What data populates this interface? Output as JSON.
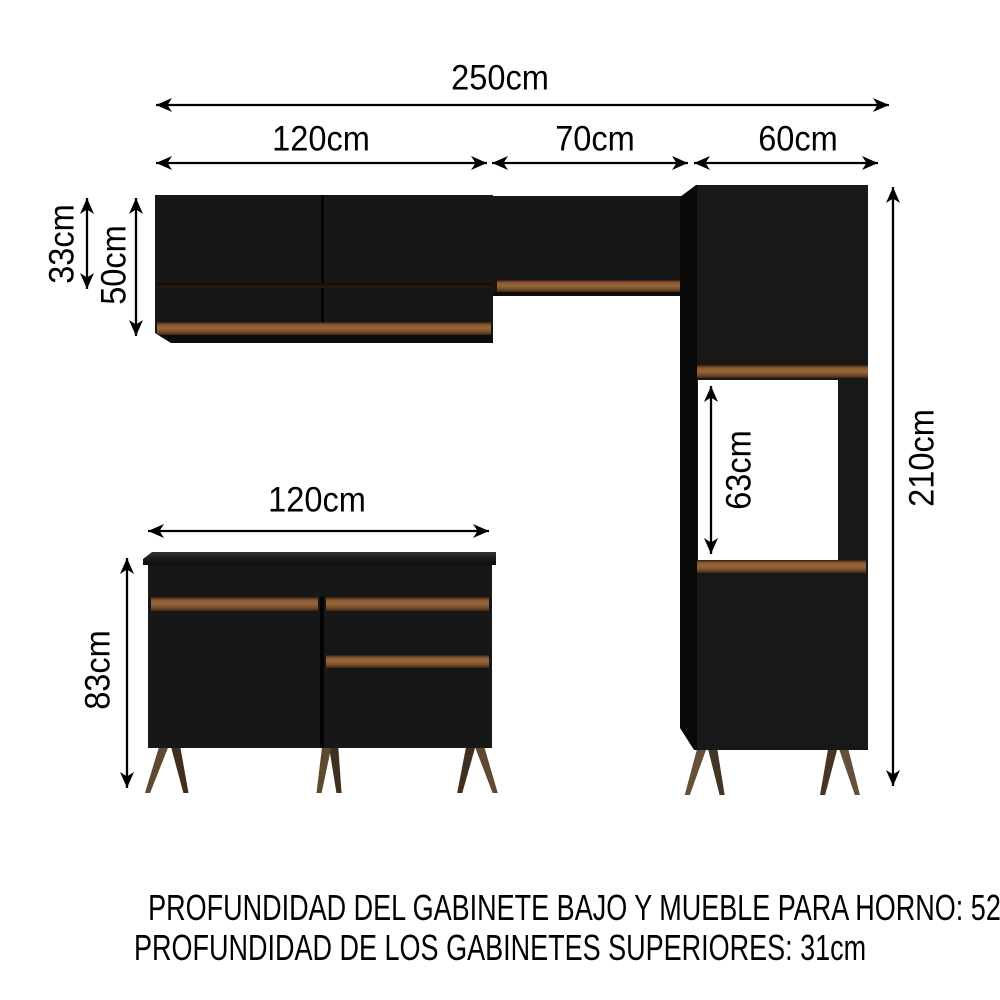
{
  "dimensions": {
    "total_width": "250cm",
    "upper_left_cabinet_width": "120cm",
    "upper_middle_cabinet_width": "70cm",
    "oven_tower_width": "60cm",
    "upper_middle_cabinet_height": "33cm",
    "upper_left_cabinet_height": "50cm",
    "oven_tower_height": "210cm",
    "oven_space_height": "63cm",
    "base_cabinet_width": "120cm",
    "base_cabinet_height": "83cm"
  },
  "footnotes": {
    "line1": "PROFUNDIDAD DEL GABINETE BAJO Y MUEBLE PARA HORNO: 52cm",
    "line2": "PROFUNDIDAD DE LOS GABINETES SUPERIORES: 31cm"
  },
  "colors": {
    "background": "#ffffff",
    "cabinet_black": "#171717",
    "cabinet_shadow": "#090909",
    "wood_trim": "#8a5a33",
    "wood_leg": "#5f4930",
    "dimension_lines": "#000000"
  }
}
